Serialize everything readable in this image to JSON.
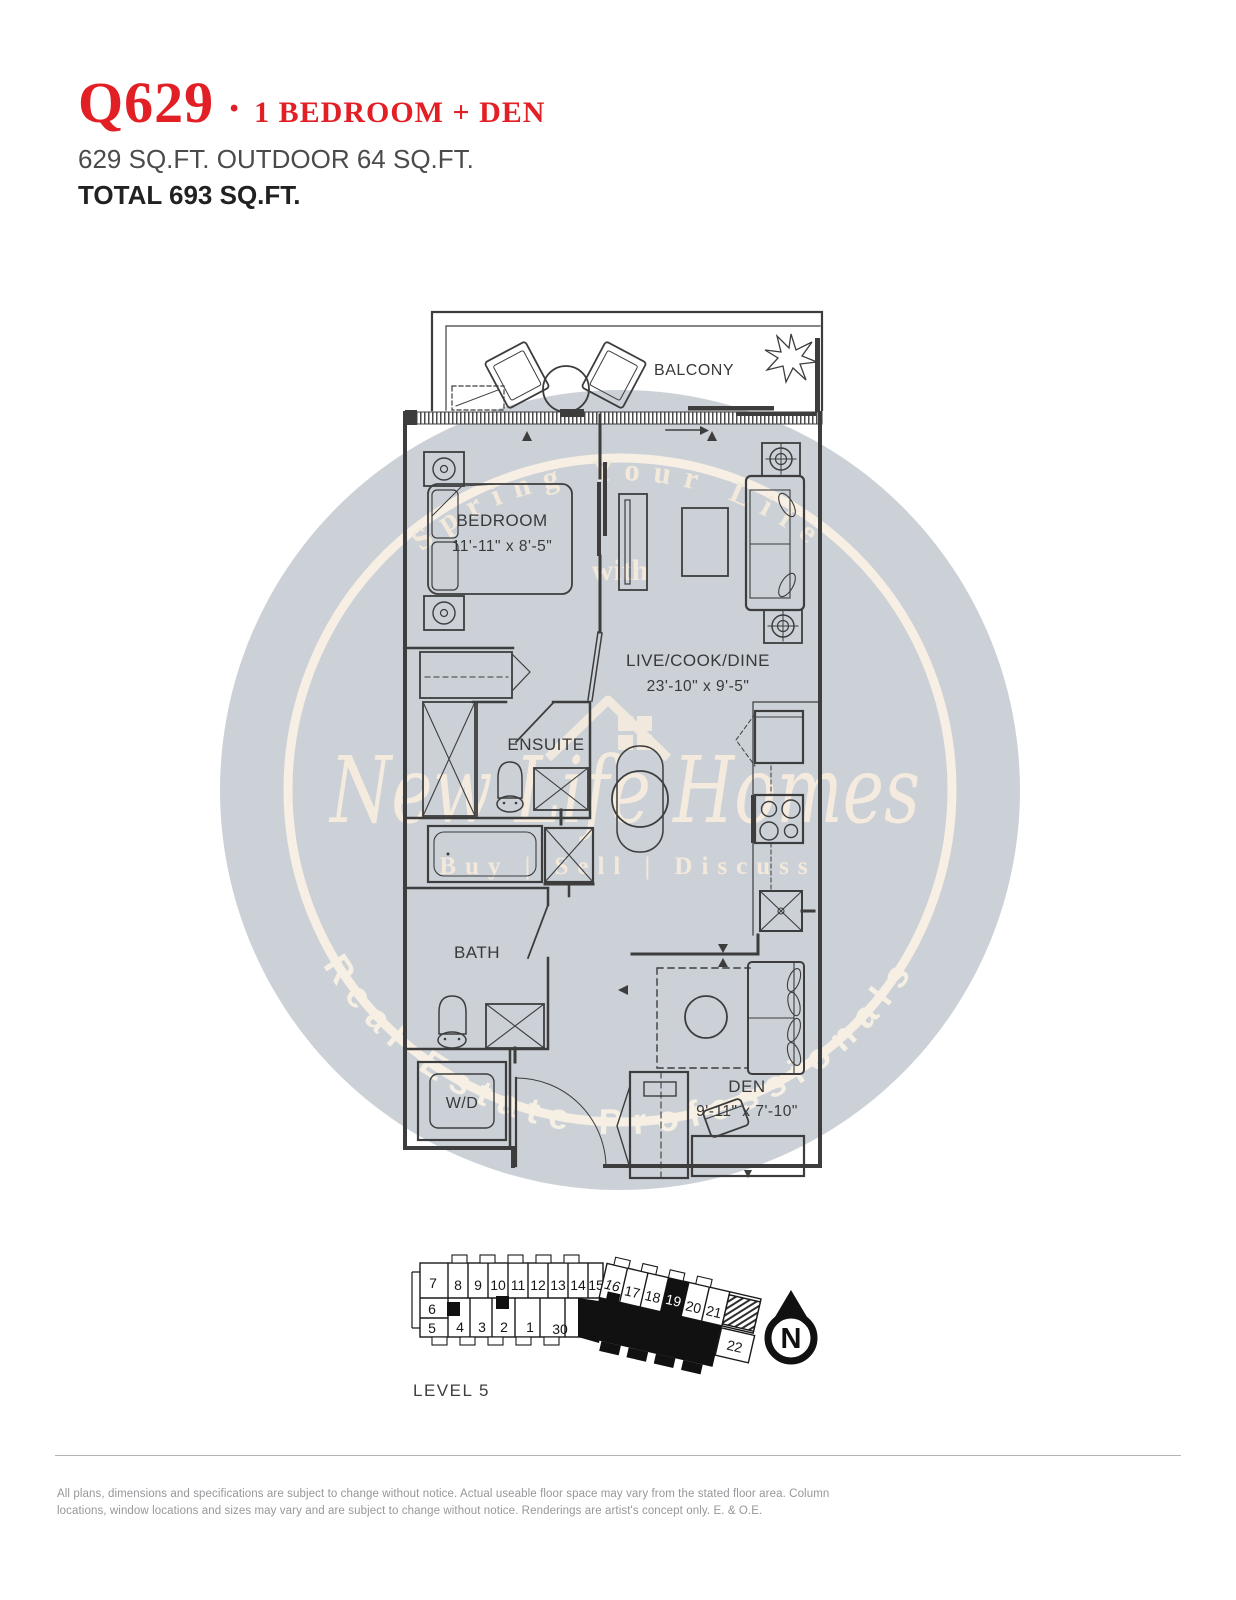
{
  "header": {
    "unit_code": "Q629",
    "separator": "·",
    "unit_type": "1 BEDROOM + DEN",
    "area_line": "629 SQ.FT. OUTDOOR 64 SQ.FT.",
    "total_line": "TOTAL 693 SQ.FT."
  },
  "watermark": {
    "arc_top": "Spring Your Life",
    "connector": "with",
    "brand": "New Life Homes",
    "tagline": "Buy | Sell | Discuss",
    "arc_bottom": "Real Estate Professionals"
  },
  "floorplan": {
    "balcony_label": "BALCONY",
    "bedroom_label": "BEDROOM",
    "bedroom_dims": "11'-11\" x 8'-5\"",
    "living_label": "LIVE/COOK/DINE",
    "living_dims": "23'-10\" x 9'-5\"",
    "ensuite_label": "ENSUITE",
    "bath_label": "BATH",
    "laundry_label": "W/D",
    "den_label": "DEN",
    "den_dims": "9'-11\" x 7'-10\""
  },
  "keyplan": {
    "level_label": "LEVEL 5",
    "highlighted_unit": "19",
    "north_label": "N",
    "units_top": [
      "7",
      "8",
      "9",
      "10",
      "11",
      "12",
      "13",
      "14",
      "15",
      "16",
      "17",
      "18",
      "19",
      "20",
      "21"
    ],
    "units_bottom": [
      "6",
      "5",
      "4",
      "3",
      "2",
      "1",
      "30",
      "22"
    ]
  },
  "footer": {
    "disclaimer_line1": "All plans, dimensions and specifications are subject to change without notice. Actual useable floor space may vary from the stated floor area. Column",
    "disclaimer_line2": "locations, window locations and sizes may vary and are subject to change without notice. Renderings are artist's concept only. E. & O.E."
  }
}
